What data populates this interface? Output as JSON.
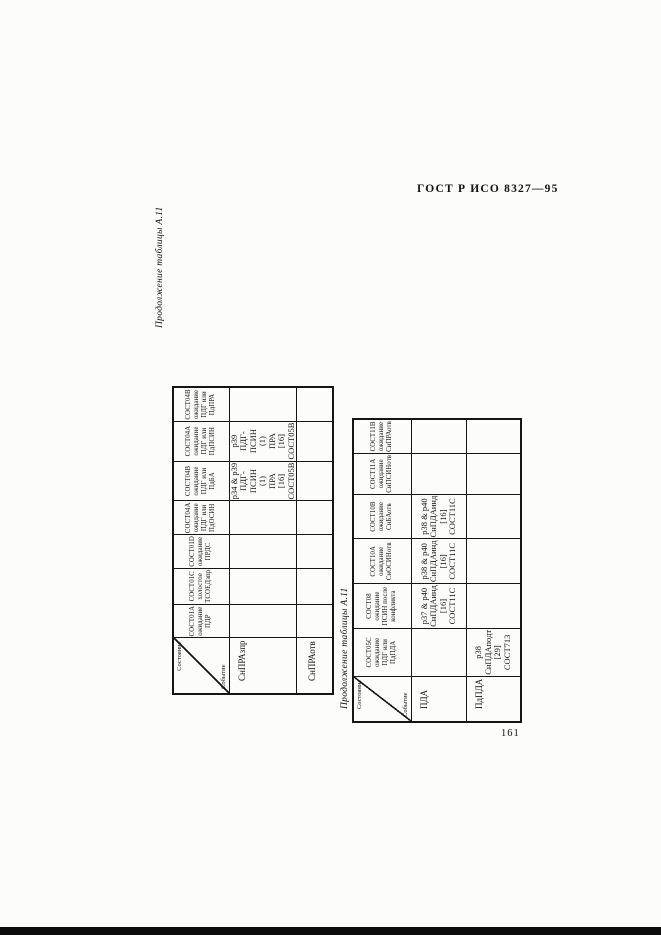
{
  "page": {
    "header": "ГОСТ Р ИСО  8327—95",
    "page_number": "161"
  },
  "tables": [
    {
      "caption": "Продолжение таблицы А.11",
      "corner": {
        "state_label": "Состояние",
        "event_label": "Событие"
      },
      "columns": [
        "СОСТ01А\nожидание\nПДР",
        "СОСТ01С\nхолостое\nТСОЕДзпр",
        "СОСТ01D\nожидание\nПРДС",
        "СОСТ04А\nожидание\nПДГ или\nПдОСИН",
        "СОСТ04В\nожидание\nПДГ или\nПдБА",
        "СОСТ04А\nожидание\nПДГ или\nПдПСИН",
        "СОСТ04В\nожидание\nПДГ или\nПдПРА"
      ],
      "rows": [
        {
          "label": "СнПРАзпр",
          "cells": [
            "",
            "",
            "",
            "",
            "р34 & р39\nПДГ-ПСИН\n(1)\nПРА\n[16]\nСОСТ05В",
            "р39\nПДГ-ПСИН\n(1)\nПРА\n[16]\nСОСТ05В",
            ""
          ]
        },
        {
          "label": "СнПРАотв",
          "cells": [
            "",
            "",
            "",
            "",
            "",
            "",
            ""
          ]
        }
      ]
    },
    {
      "caption": "Продолжение таблицы А.11",
      "corner": {
        "state_label": "Состояние",
        "event_label": "Событие"
      },
      "columns": [
        "СОСТ05С\nожидание\nПДГ или\nПдПДА",
        "СОСТ08\nожидание\nПСИН после\nконфликта",
        "СОСТ10А\nожидание\nСнОСИНотв",
        "СОСТ10В\nожидание\nСнБАотв",
        "СОСТ11А\nожидание\nСнПСИНотв",
        "СОСТ11В\nожидание\nСнПРАотв"
      ],
      "rows": [
        {
          "label": "ПДА",
          "cells": [
            "",
            "р37 & р40\nСнПДАинд\n[16]\nСОСТ11С",
            "р38 & р40\nСнПДАинд\n[16]\nСОСТ11С",
            "р38 & р40\nСнПДАинд\n[16]\nСОСТ11С",
            "",
            ""
          ]
        },
        {
          "label": "ПдПДА",
          "cells": [
            "р38\nСнПДАподт\n[29]\nСОСТ713",
            "",
            "",
            "",
            "",
            ""
          ]
        }
      ]
    }
  ]
}
